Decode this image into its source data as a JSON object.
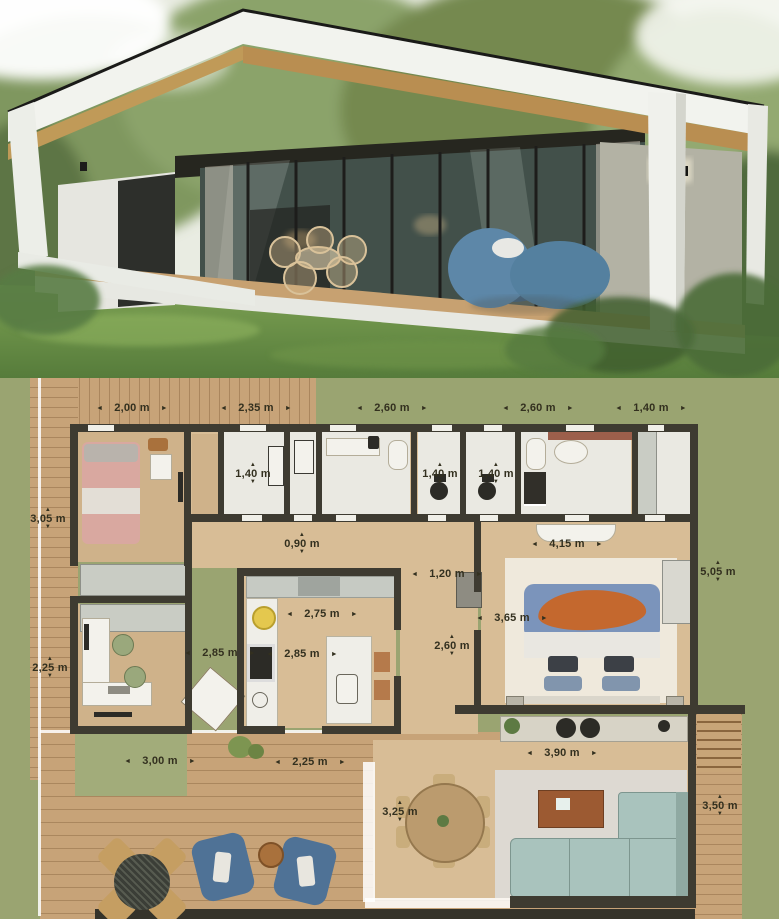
{
  "photo": {
    "subject": "modern-flat-roof-house-render"
  },
  "plan": {
    "dims": {
      "top": [
        "2,00 m",
        "2,35 m",
        "2,60 m",
        "2,60 m",
        "1,40 m"
      ],
      "left": [
        "3,05 m",
        "2,25 m"
      ],
      "right": [
        "5,05 m",
        "3,50 m"
      ],
      "closet": "1,40 m",
      "wc_left": "1,40 m",
      "wc_right": "1,40 m",
      "hall": "0,90 m",
      "master_width": "4,15 m",
      "passage": "1,20 m",
      "kitchen_width": "2,75 m",
      "kitchen_run_left": "2,85 m",
      "kitchen_run_right": "2,85 m",
      "bed_width": "3,65 m",
      "corridor_height": "2,60 m",
      "deck_office": "3,00 m",
      "deck_hall": "2,25 m",
      "living_width": "3,90 m",
      "dining_depth": "3,25 m"
    }
  },
  "colors": {
    "grass": "#9aa471",
    "deck_wood": "#c7a378",
    "floor_wood": "#d8bd96",
    "wall": "#3e3b31",
    "room_white": "#eae9e2",
    "bed_pink": "#d9a8a0",
    "bed_blue": "#7b94bb",
    "bed_orange": "#c4682e",
    "sofa_teal": "#a9c3bd",
    "outdoor_blue": "#4f7296",
    "accent_yellow": "#e4c84e"
  }
}
